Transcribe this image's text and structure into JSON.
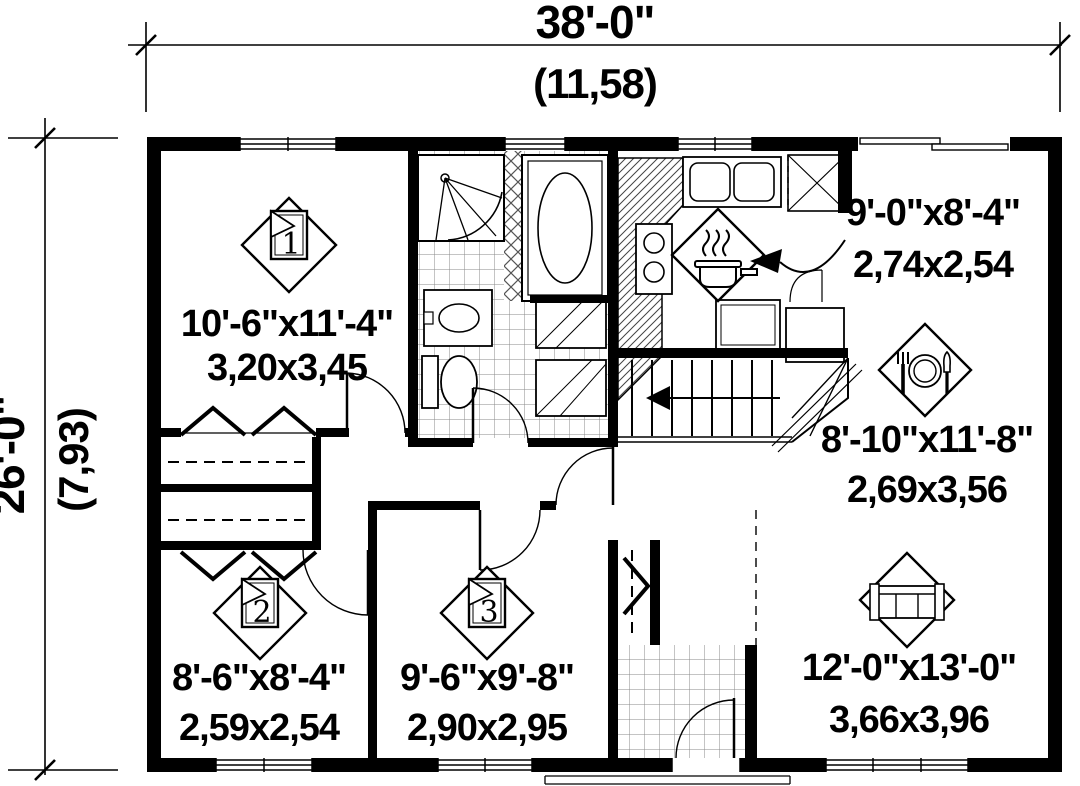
{
  "plan": {
    "title": "single-storey house floor plan",
    "dimensions": {
      "width_imperial": "38'-0\"",
      "width_metric": "(11,58)",
      "height_imperial": "26'-0\"",
      "height_metric": "(7,93)"
    },
    "rooms": [
      {
        "name": "bedroom-1",
        "number": "1",
        "icon": "bed-icon",
        "imperial": "10'-6\"x11'-4\"",
        "metric": "3,20x3,45"
      },
      {
        "name": "kitchen",
        "icon": "cooking-pot-icon",
        "imperial": "9'-0\"x8'-4\"",
        "metric": "2,74x2,54"
      },
      {
        "name": "dining",
        "icon": "cutlery-icon",
        "imperial": "8'-10\"x11'-8\"",
        "metric": "2,69x3,56"
      },
      {
        "name": "bedroom-2",
        "number": "2",
        "icon": "bed-icon",
        "imperial": "8'-6\"x8'-4\"",
        "metric": "2,59x2,54"
      },
      {
        "name": "bedroom-3",
        "number": "3",
        "icon": "bed-icon",
        "imperial": "9'-6\"x9'-8\"",
        "metric": "2,90x2,95"
      },
      {
        "name": "living",
        "icon": "sofa-icon",
        "imperial": "12'-0\"x13'-0\"",
        "metric": "3,66x3,96"
      }
    ],
    "colors": {
      "line": "#000000",
      "background": "#ffffff"
    }
  }
}
